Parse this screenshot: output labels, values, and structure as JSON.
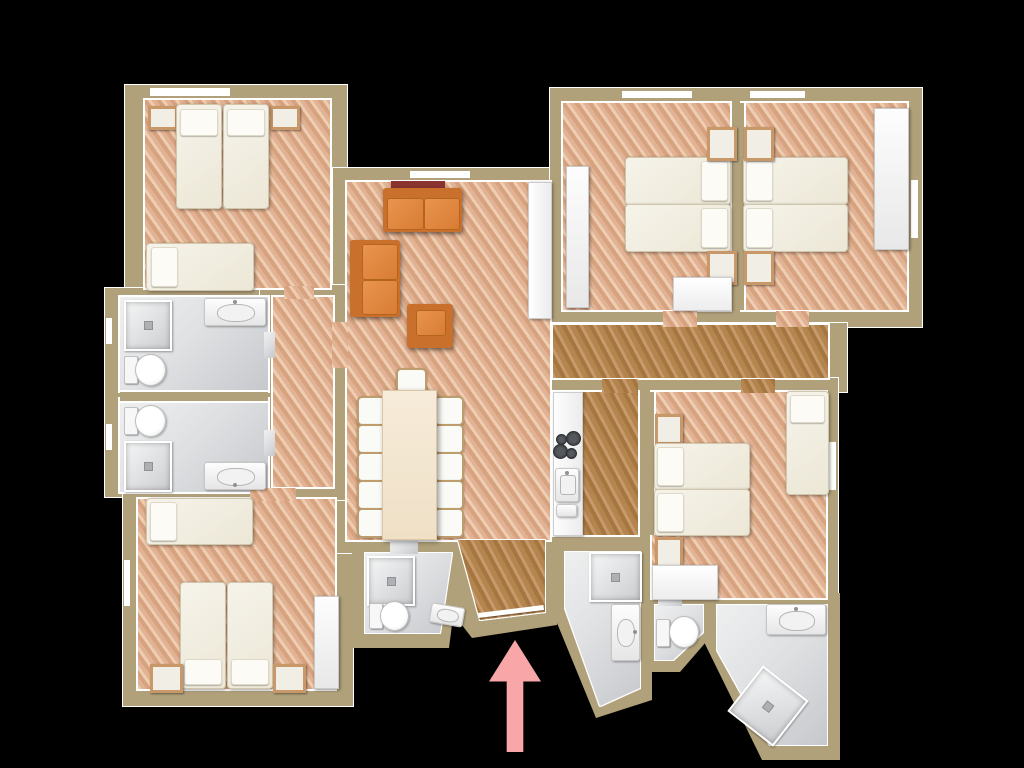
{
  "scene": "apartment floor plan, 3D top-down render, black background, pink arrow marking entrance at bottom center",
  "entrance": {
    "indicator": "up-arrow",
    "color": "#f9a6a9"
  },
  "colors": {
    "bg": "#000000",
    "wall": "#b1a17b",
    "line": "#ffffff",
    "wood": "#e2b294",
    "wood-hi": "#efcdb0",
    "wood-lo": "#d6a27f",
    "woodd": "#b5854f",
    "woodd-hi": "#c79a6c",
    "woodd-lo": "#a5763f",
    "tile-a": "#eef0f0",
    "tile-b": "#c6c8cc",
    "bed": "#ece7d6",
    "bed-edge": "#cfc6ac",
    "pillow": "#fcfbf6",
    "wood-frame": "#c89868",
    "white-furn": "#fdfdfd",
    "sofa": "#d87c33",
    "sofa-dark": "#b5641f",
    "sofa-frame": "#c9702d",
    "table": "#f7ecda",
    "chair-edge": "#bd9c6d",
    "red-board": "#8a3430",
    "arrow": "#f9a6a9",
    "arrow-edge": "#ef8f96"
  },
  "rooms": [
    {
      "name": "bedroom-top-left",
      "floor": "wood",
      "furniture": [
        "single-bed",
        "single-bed",
        "single-bed",
        "nightstand",
        "nightstand"
      ]
    },
    {
      "name": "bathroom-upper-left",
      "floor": "tile",
      "furniture": [
        "shower",
        "toilet",
        "washbasin"
      ]
    },
    {
      "name": "bathroom-lower-left",
      "floor": "tile",
      "furniture": [
        "shower",
        "toilet",
        "washbasin"
      ]
    },
    {
      "name": "bedroom-bottom-left",
      "floor": "wood",
      "furniture": [
        "single-bed",
        "single-bed",
        "single-bed",
        "nightstand",
        "nightstand",
        "wardrobe"
      ]
    },
    {
      "name": "living-room",
      "floor": "wood",
      "furniture": [
        "sofa",
        "sofa",
        "armchair",
        "sideboard"
      ]
    },
    {
      "name": "dining-area",
      "floor": "wood",
      "furniture": [
        "dining-table",
        "chair",
        "chair",
        "chair",
        "chair",
        "chair",
        "chair",
        "chair",
        "chair",
        "chair",
        "chair",
        "chair"
      ]
    },
    {
      "name": "kitchen",
      "floor": "wood-dark",
      "furniture": [
        "counter",
        "cooktop-4-burners",
        "sink"
      ]
    },
    {
      "name": "bedroom-top-right-west",
      "floor": "wood",
      "furniture": [
        "single-bed",
        "single-bed",
        "wardrobe",
        "nightstand",
        "nightstand",
        "desk"
      ]
    },
    {
      "name": "bedroom-top-right-east",
      "floor": "wood",
      "furniture": [
        "single-bed",
        "single-bed",
        "wardrobe",
        "nightstand",
        "nightstand"
      ]
    },
    {
      "name": "bedroom-middle-right",
      "floor": "wood",
      "furniture": [
        "single-bed",
        "single-bed",
        "single-bed",
        "nightstand",
        "nightstand",
        "desk"
      ]
    },
    {
      "name": "hallway-east",
      "floor": "wood-dark",
      "furniture": []
    },
    {
      "name": "hallway-west",
      "floor": "wood",
      "furniture": []
    },
    {
      "name": "entry-hall",
      "floor": "wood-dark",
      "furniture": []
    },
    {
      "name": "bathroom-bottom-center",
      "floor": "tile",
      "furniture": [
        "shower",
        "toilet",
        "washbasin"
      ]
    },
    {
      "name": "bathroom-bottom-middle",
      "floor": "tile",
      "furniture": [
        "shower",
        "washbasin"
      ]
    },
    {
      "name": "wc-bottom",
      "floor": "tile",
      "furniture": [
        "toilet"
      ]
    },
    {
      "name": "bathroom-bottom-right",
      "floor": "tile",
      "furniture": [
        "washbasin",
        "shower"
      ]
    }
  ]
}
